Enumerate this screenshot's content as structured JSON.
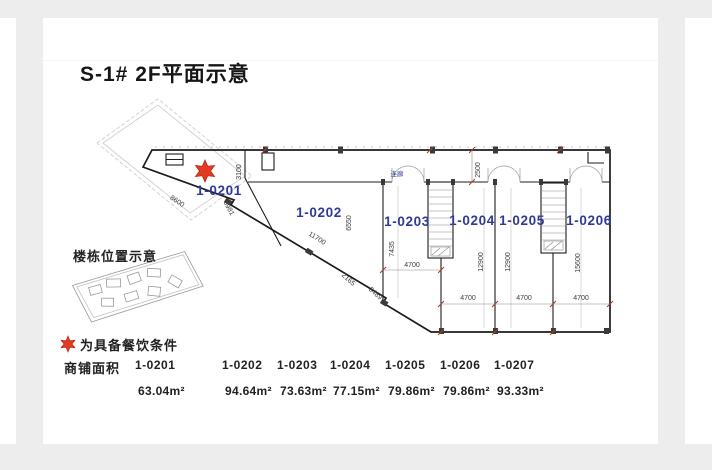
{
  "page": {
    "title": "S-1# 2F平面示意"
  },
  "plan": {
    "unit_labels": [
      "1-0201",
      "1-0202",
      "1-0203",
      "1-0204",
      "1-0205",
      "1-0206"
    ],
    "corridor_label": "连廊",
    "dims": {
      "d8600": "8600",
      "d3981": "3981",
      "d3100": "3100",
      "d11700": "11700",
      "d6550": "6550",
      "d7435": "7435",
      "d2165": "2165",
      "d3489": "3489",
      "d2500": "2500",
      "d4700": "4700",
      "d12900": "12900",
      "d15600": "15600"
    }
  },
  "legend": {
    "location_title": "楼栋位置示意",
    "star_note": "为具备餐饮条件"
  },
  "table": {
    "row_label": "商铺面积",
    "units": [
      {
        "id": "1-0201",
        "area": "63.04m²"
      },
      {
        "id": "1-0202",
        "area": "94.64m²"
      },
      {
        "id": "1-0203",
        "area": "73.63m²"
      },
      {
        "id": "1-0204",
        "area": "77.15m²"
      },
      {
        "id": "1-0205",
        "area": "79.86m²"
      },
      {
        "id": "1-0206",
        "area": "79.86m²"
      },
      {
        "id": "1-0207",
        "area": "93.33m²"
      }
    ]
  },
  "colors": {
    "accent_blue": "#2e3b96",
    "star_red": "#e23b23",
    "frame_gray": "#ededed"
  }
}
